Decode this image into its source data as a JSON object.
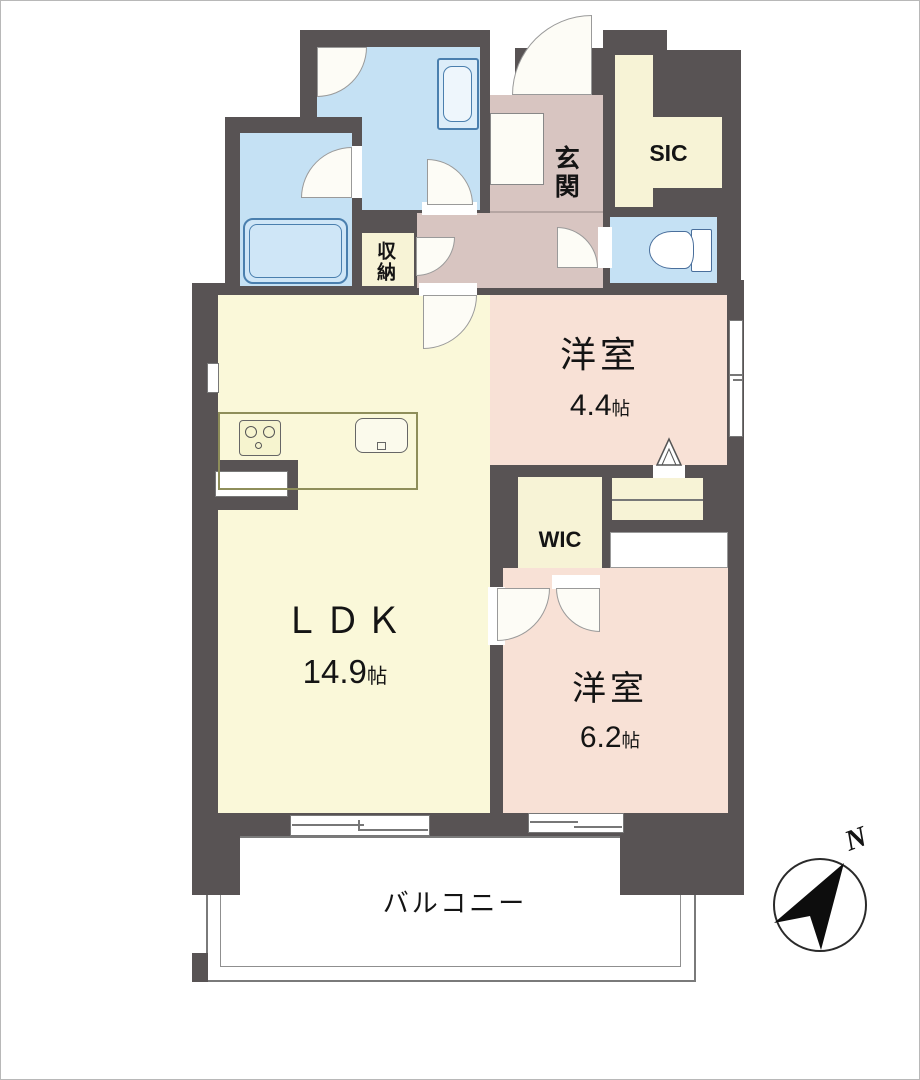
{
  "floorplan": {
    "rooms": {
      "ldk": {
        "label": "ＬＤＫ",
        "size": "14.9",
        "unit": "帖"
      },
      "western_room_44": {
        "label": "洋室",
        "size": "4.4",
        "unit": "帖"
      },
      "western_room_62": {
        "label": "洋室",
        "size": "6.2",
        "unit": "帖"
      },
      "wic": {
        "label": "WIC"
      },
      "sic": {
        "label": "SIC"
      },
      "entrance": {
        "label": "玄関"
      },
      "storage": {
        "label": "収納"
      },
      "balcony": {
        "label": "バルコニー"
      }
    },
    "compass": {
      "north_label": "N"
    },
    "fixtures": [
      "bathtub",
      "washing-machine",
      "toilet",
      "stove",
      "kitchen-sink",
      "shoe-cabinet",
      "kitchen-counter"
    ],
    "colors": {
      "wall": "#585354",
      "wet_area_blue": "#c5e1f4",
      "bedroom_pink": "#f8e1d6",
      "hall_pink": "#d8c5c1",
      "ldk_cream": "#faf8d9",
      "closet_cream": "#f7f3d6",
      "fixture_blue": "#4a7fae"
    }
  }
}
